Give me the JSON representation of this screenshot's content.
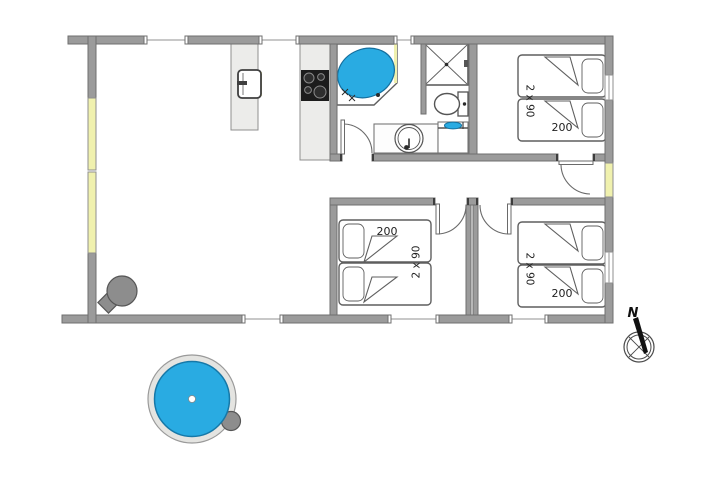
{
  "colors": {
    "wall": "#9b9b9b",
    "water_blue": "#29abe2",
    "window_glass": "#f0f1ae",
    "counter": "#ececea"
  },
  "bedrooms": {
    "top_right": {
      "bed_size_label": "2 x 90",
      "bed_length_label": "200"
    },
    "middle": {
      "bed_size_label": "2 x 90",
      "bed_length_label": "200"
    },
    "bottom_right": {
      "bed_size_label": "2 x 90",
      "bed_length_label": "200"
    }
  },
  "compass": {
    "north_label": "N"
  },
  "fixtures": {
    "bathtub": "corner-bathtub",
    "shower": "shower-cabin",
    "toilet": "toilet",
    "washbasin": "round-washbasin",
    "washer": "washing-machine",
    "kitchen_sink": "kitchen-sink",
    "cooktop": "cooktop-4-burners",
    "stove": "wood-burning-stove",
    "hot_tub": "outdoor-hot-tub"
  }
}
